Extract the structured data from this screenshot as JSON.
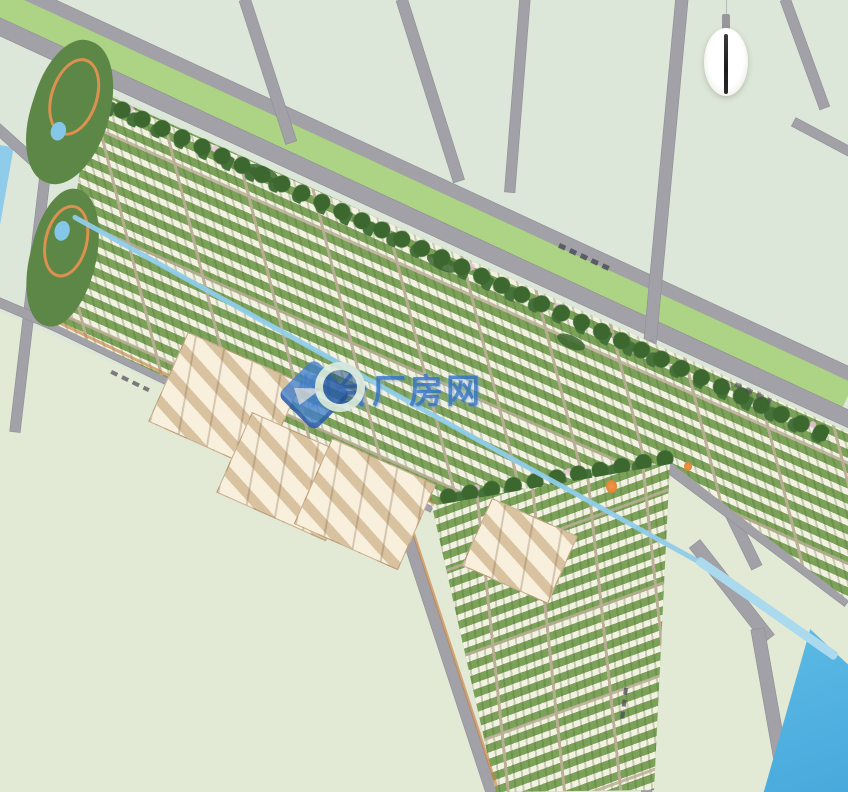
{
  "app": {
    "name": "residential-district-masterplan-map"
  },
  "watermark": {
    "text": "烟台厂房网",
    "logo": "diamond-ring-logo",
    "color": "#2E7CD0"
  },
  "compass": {
    "type": "north-needle-compass"
  },
  "palette": {
    "field": "#dde7d9",
    "field_south": "#e2e9d5",
    "road": "#a2a1a8",
    "road_edge": "#8e8d95",
    "verge": "#add385",
    "dev_base": "#7ca25a",
    "building_row": "#f6f3e7",
    "tree": "#3c672f",
    "street_tan": "#bcae8f",
    "beige_ground": "#e6d6b8",
    "beige_building": "#f8f0dc",
    "water_river": "#5fbce6",
    "water_canal": "#8fcce9",
    "park": "#5d8746",
    "path_orange": "#dc9150",
    "pond": "#85c7e8",
    "orange_marker": "#e07b28",
    "compass_needle": "#1c1c1c",
    "watermark_blue": "#2e7cd0"
  },
  "features": [
    "tree-lined-arterial-road",
    "residential-building-rows",
    "campus-beige-buildings",
    "central-canal",
    "riverside-corner",
    "corner-parks-with-ponds",
    "field-parcels",
    "north-compass",
    "site-watermark"
  ]
}
